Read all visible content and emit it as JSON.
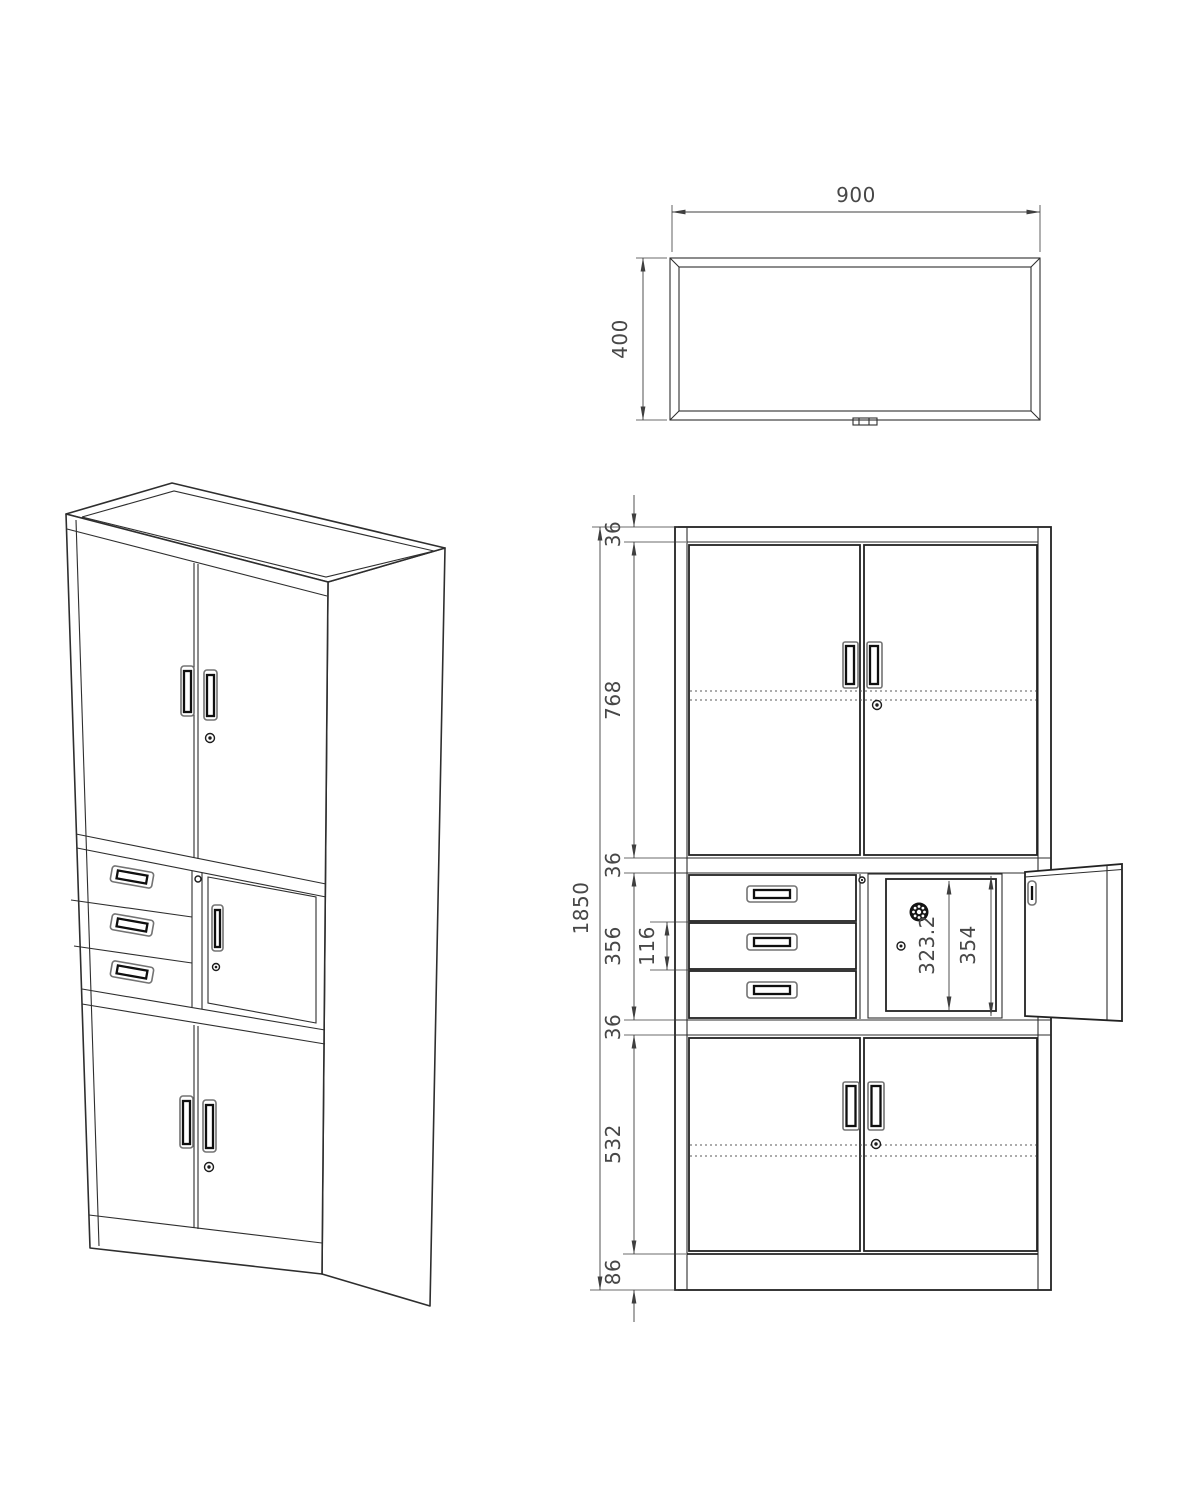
{
  "colors": {
    "background": "#ffffff",
    "line": "#2e2e2e",
    "dimension": "#474747"
  },
  "top_view": {
    "width": "900",
    "depth": "400"
  },
  "front_view": {
    "overall_height": "1850",
    "top_frame": "36",
    "upper_doors": "768",
    "divider_upper": "36",
    "middle_section": "356",
    "middle_drawer": "116",
    "divider_lower": "36",
    "lower_doors": "532",
    "base": "86",
    "safe_door_height": "323.2",
    "safe_opening_height": "354"
  }
}
